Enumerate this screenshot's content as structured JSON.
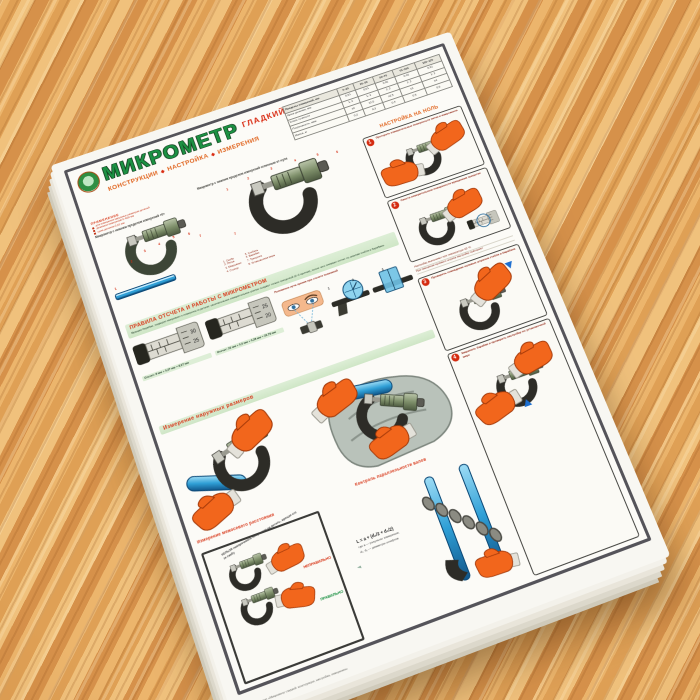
{
  "poster": {
    "title": "МИКРОМЕТР",
    "qualifier": "ГЛАДКИЙ",
    "subtitle_words": [
      "КОНСТРУКЦИИ",
      "НАСТРОЙКА",
      "ИЗМЕРЕНИЯ"
    ],
    "subtitle_sep": "◆",
    "spec_table": {
      "header": [
        "Пределы измерений, мм",
        "0–25",
        "25–50",
        "50–75",
        "75–100",
        "100–125"
      ],
      "rows": [
        [
          "Цена деления, мм",
          "0,01",
          "0,01",
          "0,01",
          "0,01",
          "0,01"
        ],
        [
          "Класс точности",
          "1; 2",
          "1; 2",
          "1; 2",
          "1; 2",
          "1; 2"
        ],
        [
          "Погрешность, мкм",
          "±2",
          "±2,5",
          "±2,5",
          "±3",
          "±4"
        ],
        [
          "Масса, кг",
          "0,2",
          "0,3",
          "0,4",
          "0,5",
          "0,6"
        ]
      ]
    },
    "application": {
      "heading": "ПРИМЕНЕНИЕ",
      "lines": [
        "для измерения наружных размеров деталей",
        "диапазон измерений 0–600 мм",
        "цена деления 0,01 мм"
      ]
    },
    "diagram_left_caption": "Микрометр с нижним пределом измерений «0»",
    "diagram_right_caption": "Микрометр с нижним пределом измерений отличным от нуля",
    "legend_col1": [
      "1. Скоба",
      "2. Пятка",
      "3. Микровинт",
      "4. Стопор"
    ],
    "legend_col2": [
      "5. Стебель",
      "6. Барабан",
      "7. Трещотка",
      "8. Установочная мера"
    ],
    "callouts": [
      "1",
      "2",
      "3",
      "4",
      "5",
      "6",
      "7"
    ],
    "rules_band": "ПРАВИЛА ОТСЧЕТА И РАБОТЫ С МИКРОМЕТРОМ",
    "rules_text": "Вращая барабан, подводят микровинт к поверхности детали; окончательное измерительное усилие создают только трещоткой (2–3 щелчка), после чего снимают отсчет по шкалам стебля и барабана.",
    "reading1": "Отсчет: 8 мм + 0,27 мм = 8,27 мм",
    "reading2": "Отсчет: 22 мм + 0,5 мм + 0,28 мм = 22,78 мм",
    "scale1": [
      "30",
      "25"
    ],
    "scale2": [
      "25",
      "20"
    ],
    "sight_caption": "Положение луча зрения при отсчете показаний",
    "sight_nums": [
      "1",
      "2",
      "3"
    ],
    "outer_band": "Измерение наружных размеров",
    "interaxial_heading": "Измерение межосевого расстояния",
    "parallel_heading": "Контроль параллельности валов",
    "donts_note": "НЕЛЬЗЯ наворачивать микрометр на деталь, вращая его за скобу",
    "wrong_label": "НЕПРАВИЛЬНО",
    "right_label": "ПРАВИЛЬНО",
    "formula_main": "L = a + (d₁/2 + d₂/2)",
    "formula_line2": "где a — результат измерения;",
    "formula_line3": "d₁, d₂ — диаметры штифтов",
    "zero_header": "НАСТРОЙКА НА НОЛЬ",
    "panels": [
      {
        "num": "1",
        "caption": "Протереть измерительные поверхности пятки и микровинта"
      },
      {
        "num": "2",
        "caption": "Свести измерительные поверхности вращением трещотки"
      },
      {
        "num": "3",
        "caption": "Проверить совпадение нулевых штрихов стебля и барабана"
      },
      {
        "num": "4",
        "caption": "Закрепить барабан и проверить настройку по установочной мере"
      }
    ],
    "zero_notes": [
      "Настройку выполняют при температуре 20 °C",
      "При смещении нулевого штриха настройку повторяют"
    ],
    "credit": "Учебный плакат «Микрометр гладкий: конструкции, настройка, измерения»"
  }
}
